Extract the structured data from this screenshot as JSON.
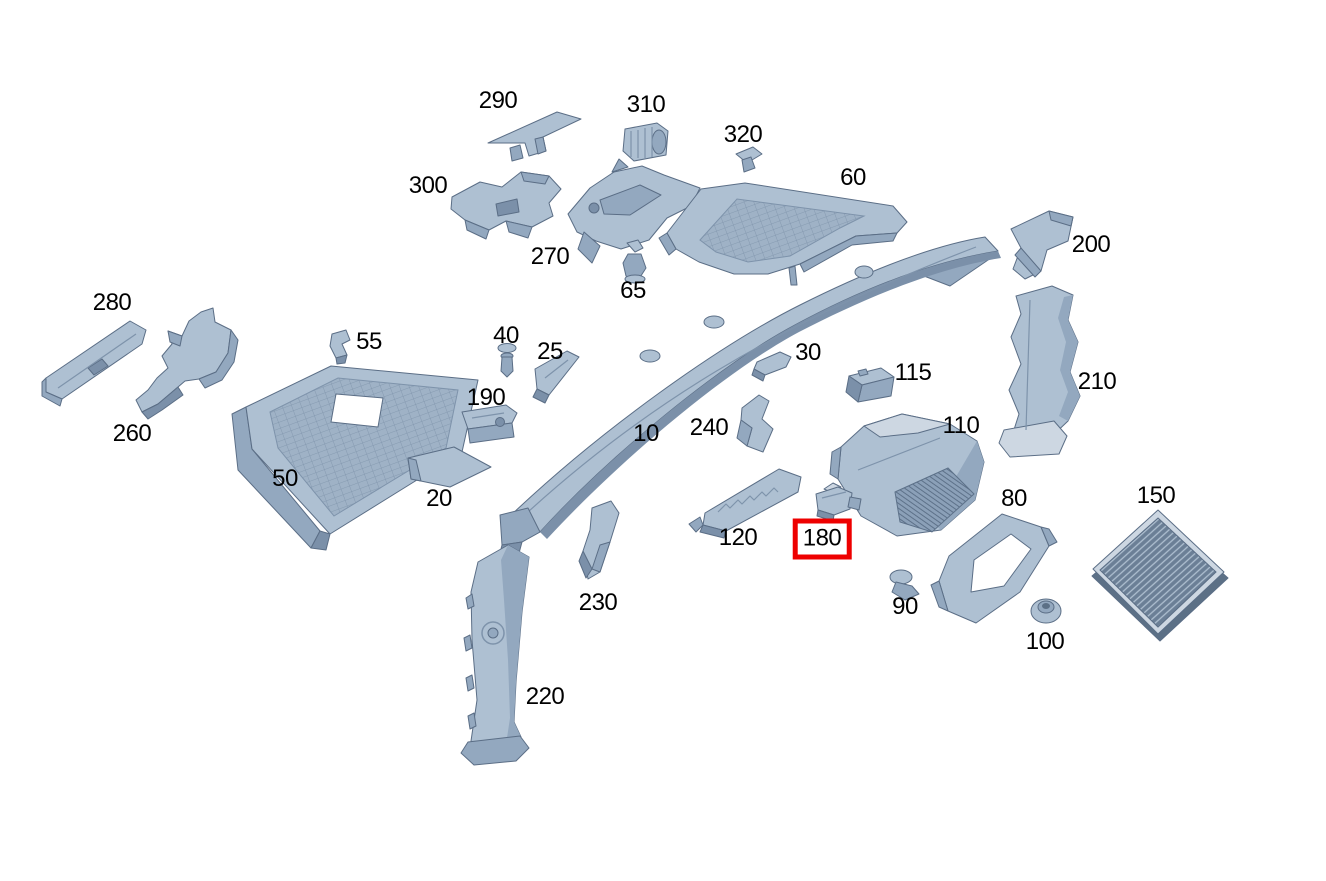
{
  "diagram": {
    "type": "exploded-parts-diagram",
    "description": "Vehicle cowl / firewall area exploded parts view with numbered callouts",
    "background_color": "#ffffff",
    "label_color": "#000000",
    "label_font_size_px": 24,
    "highlight": {
      "part": "180",
      "box_color": "#ee0000"
    },
    "part_colors": {
      "light": "#aec0d2",
      "mid": "#93a8bf",
      "dark": "#7b90a9",
      "bright": "#cdd7e2",
      "shadow": "#5c7086",
      "outline": "#5b6e86"
    },
    "labels": [
      {
        "text": "10",
        "x": 646,
        "y": 434,
        "highlighted": false
      },
      {
        "text": "20",
        "x": 439,
        "y": 499,
        "highlighted": false
      },
      {
        "text": "25",
        "x": 550,
        "y": 352,
        "highlighted": false
      },
      {
        "text": "30",
        "x": 808,
        "y": 353,
        "highlighted": false
      },
      {
        "text": "40",
        "x": 506,
        "y": 336,
        "highlighted": false
      },
      {
        "text": "50",
        "x": 285,
        "y": 479,
        "highlighted": false
      },
      {
        "text": "55",
        "x": 369,
        "y": 342,
        "highlighted": false
      },
      {
        "text": "60",
        "x": 853,
        "y": 178,
        "highlighted": false
      },
      {
        "text": "65",
        "x": 633,
        "y": 291,
        "highlighted": false
      },
      {
        "text": "80",
        "x": 1014,
        "y": 499,
        "highlighted": false
      },
      {
        "text": "90",
        "x": 905,
        "y": 607,
        "highlighted": false
      },
      {
        "text": "100",
        "x": 1045,
        "y": 642,
        "highlighted": false
      },
      {
        "text": "110",
        "x": 961,
        "y": 426,
        "highlighted": false
      },
      {
        "text": "115",
        "x": 913,
        "y": 373,
        "highlighted": false
      },
      {
        "text": "120",
        "x": 738,
        "y": 538,
        "highlighted": false
      },
      {
        "text": "150",
        "x": 1156,
        "y": 496,
        "highlighted": false
      },
      {
        "text": "180",
        "x": 822,
        "y": 539,
        "highlighted": true
      },
      {
        "text": "190",
        "x": 486,
        "y": 398,
        "highlighted": false
      },
      {
        "text": "200",
        "x": 1091,
        "y": 245,
        "highlighted": false
      },
      {
        "text": "210",
        "x": 1097,
        "y": 382,
        "highlighted": false
      },
      {
        "text": "220",
        "x": 545,
        "y": 697,
        "highlighted": false
      },
      {
        "text": "230",
        "x": 598,
        "y": 603,
        "highlighted": false
      },
      {
        "text": "240",
        "x": 709,
        "y": 428,
        "highlighted": false
      },
      {
        "text": "260",
        "x": 132,
        "y": 434,
        "highlighted": false
      },
      {
        "text": "270",
        "x": 550,
        "y": 257,
        "highlighted": false
      },
      {
        "text": "280",
        "x": 112,
        "y": 303,
        "highlighted": false
      },
      {
        "text": "290",
        "x": 498,
        "y": 101,
        "highlighted": false
      },
      {
        "text": "300",
        "x": 428,
        "y": 186,
        "highlighted": false
      },
      {
        "text": "310",
        "x": 646,
        "y": 105,
        "highlighted": false
      },
      {
        "text": "320",
        "x": 743,
        "y": 135,
        "highlighted": false
      }
    ]
  }
}
